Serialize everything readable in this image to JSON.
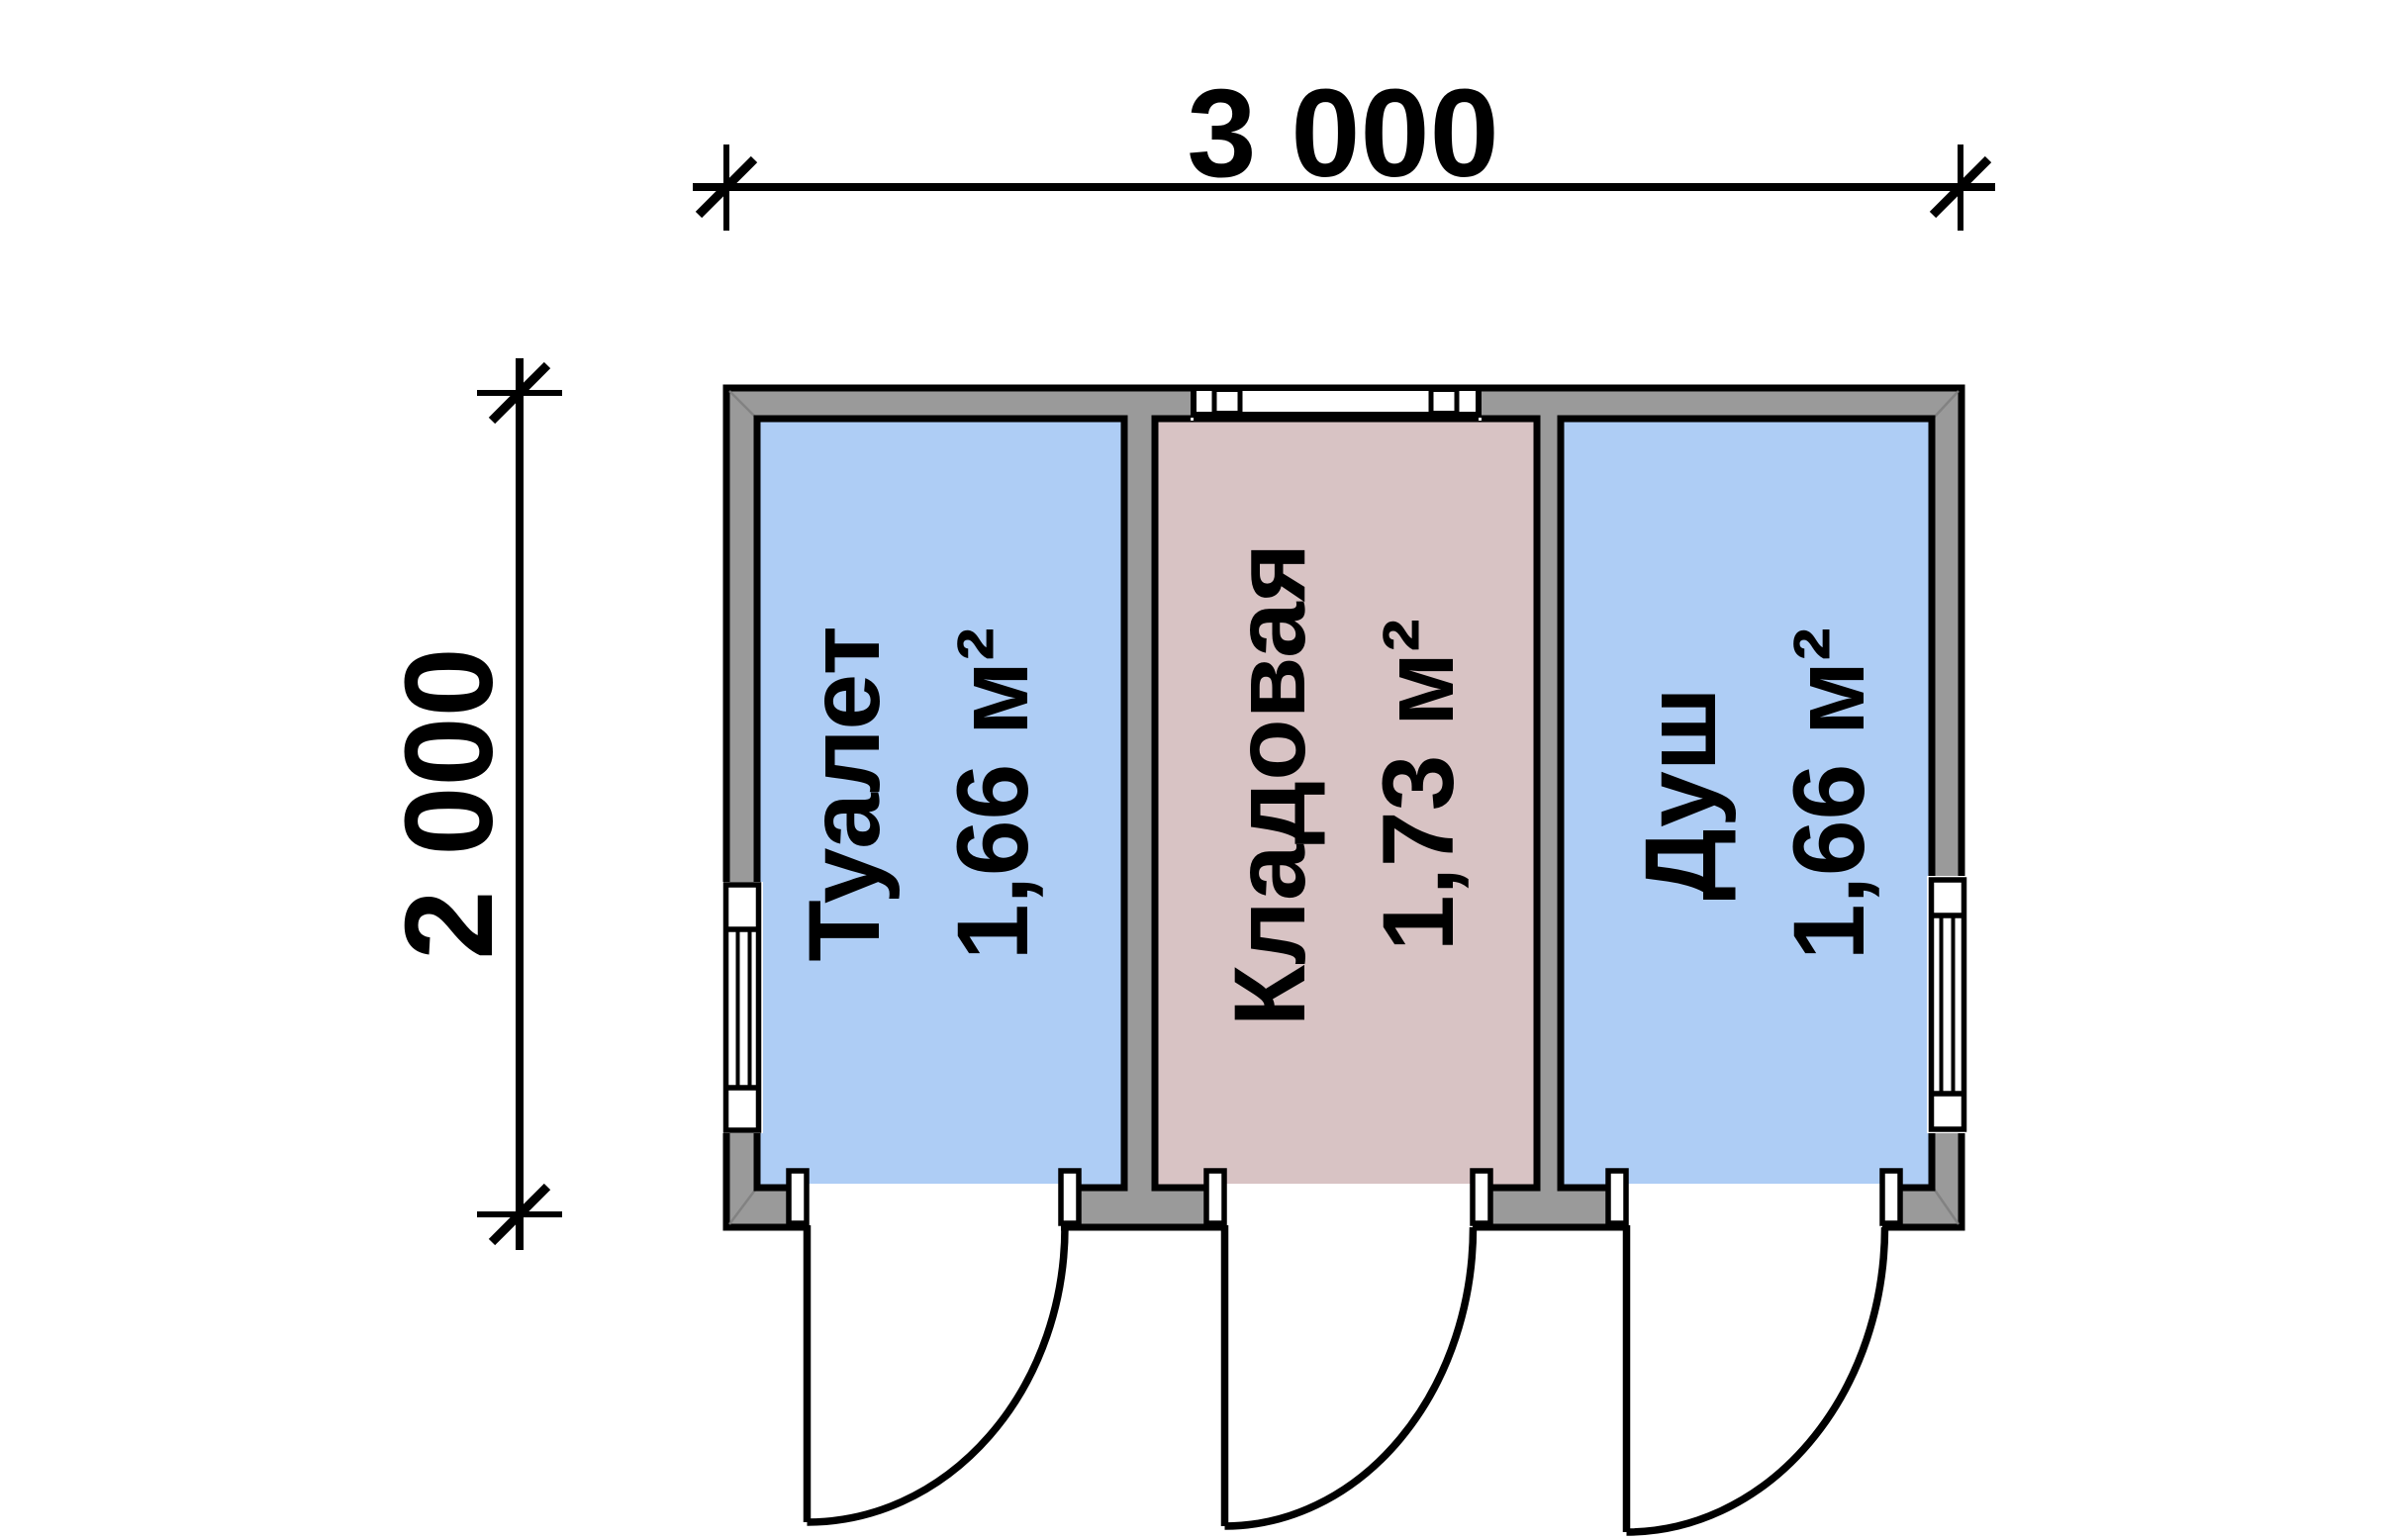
{
  "drawing": {
    "width_dimension": "3 000",
    "height_dimension": "2 000"
  },
  "rooms": [
    {
      "name": "Туалет",
      "area": "1,66 м²",
      "fill": "#aecdf5"
    },
    {
      "name": "Кладовая",
      "area": "1,73 м²",
      "fill": "#d8c3c4"
    },
    {
      "name": "Душ",
      "area": "1,66 м²",
      "fill": "#aecdf5"
    }
  ],
  "colors": {
    "wall": "#9a9a9a",
    "line": "#000000",
    "window": "#ffffff",
    "background": "#ffffff"
  }
}
